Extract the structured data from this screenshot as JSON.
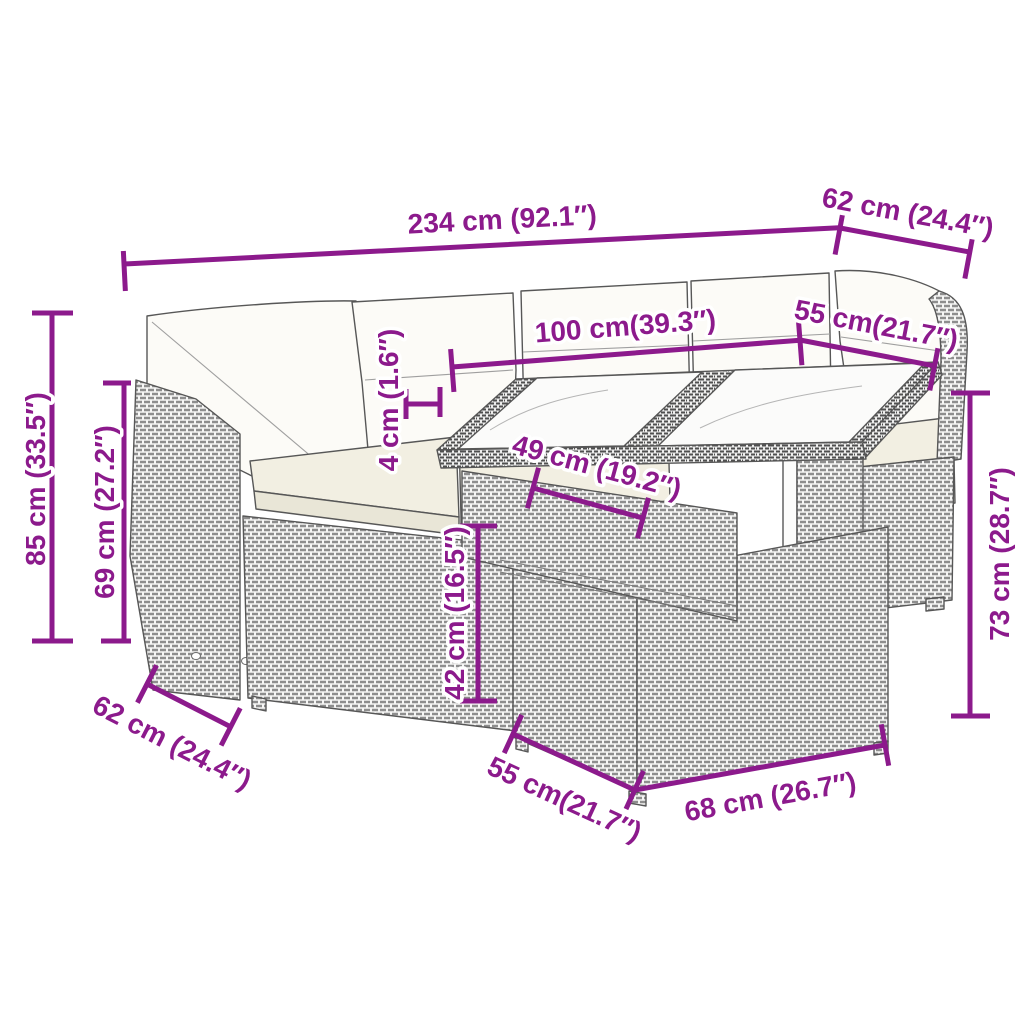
{
  "style": {
    "accent_color": "#8C1A8C",
    "artwork_line_color": "#575757",
    "background": "#ffffff"
  },
  "dimensions": {
    "overall_width": "234 cm (92.1″)",
    "top_depth": "62 cm (24.4″)",
    "tabletop_length": "100 cm(39.3″)",
    "tabletop_depth": "55 cm(21.7″)",
    "tabletop_thickness": "4 cm (1.6″)",
    "lower_table_length": "49 cm (19.2″)",
    "overall_height": "85 cm (33.5″)",
    "backrest_height": "69 cm (27.2″)",
    "seat_base_height": "42 cm (16.5″)",
    "table_height": "73 cm (28.7″)",
    "seat_module_depth": "62 cm (24.4″)",
    "table_base_depth": "55 cm(21.7″)",
    "table_base_length": "68 cm (26.7″)"
  }
}
